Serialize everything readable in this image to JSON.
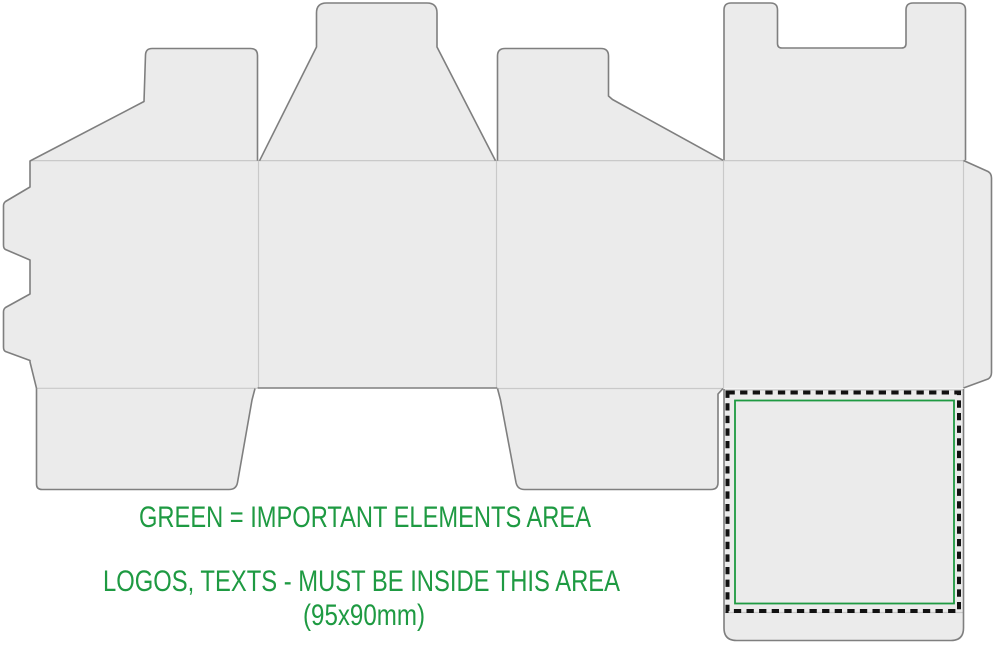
{
  "colors": {
    "background": "#ffffff",
    "panel_fill": "#ebebeb",
    "cut_line": "#7f7f7f",
    "fold_line": "#c9c9c9",
    "accent_green": "#1e9a42",
    "dash_black": "#111111"
  },
  "annotation": {
    "line1": "GREEN = IMPORTANT ELEMENTS AREA",
    "line2": "LOGOS, TEXTS - MUST BE INSIDE THIS AREA",
    "line3": "(95x90mm)"
  },
  "safe_area": {
    "size_label": "95x90mm"
  }
}
